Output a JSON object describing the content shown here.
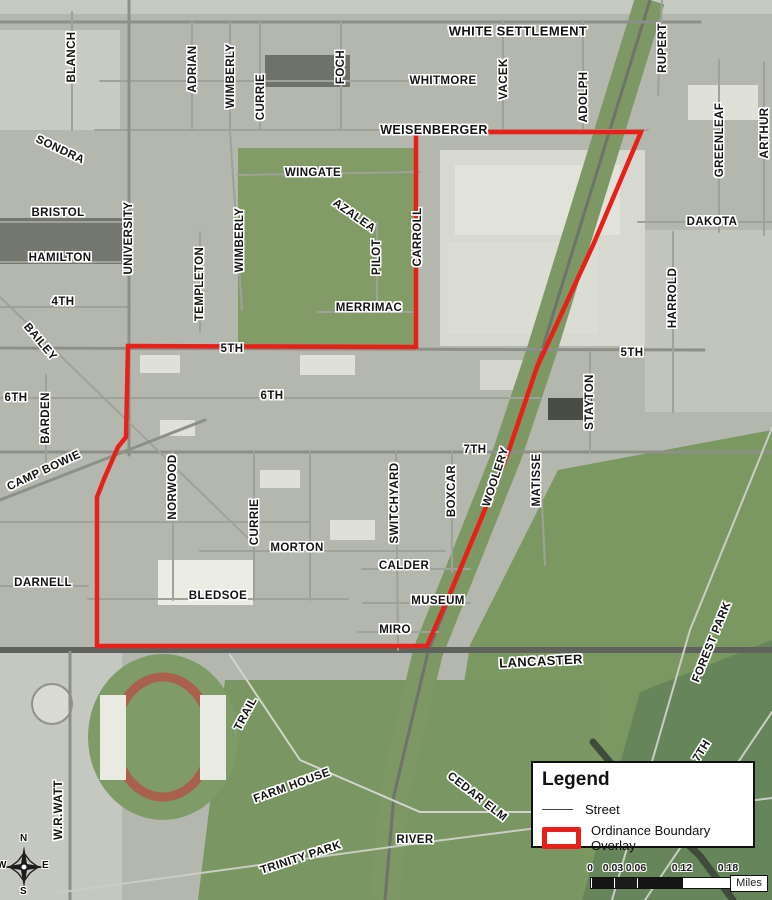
{
  "map": {
    "width": 772,
    "height": 900,
    "colors": {
      "boundary": "#e8201a",
      "road_main": "#8d9088",
      "road_minor": "#9fa29a",
      "road_light": "#c9cdc4",
      "road_dark": "#60635c",
      "rail_band": "#7d9765"
    },
    "boundary_points": "416,132 641,132 594,243 537,367 509,450 479,524 451,591 427,646 97,646 97,497 104,479 118,447 126,437 128,346 416,347",
    "patches": [
      {
        "r": [
          0,
          0,
          772,
          14
        ],
        "c": "#c6c9c2"
      },
      {
        "r": [
          0,
          30,
          120,
          100
        ],
        "c": "#c8cbc4"
      },
      {
        "r": [
          238,
          148,
          180,
          200
        ],
        "c": "#839b67"
      },
      {
        "r": [
          440,
          150,
          205,
          196
        ],
        "c": "#d7d8d0"
      },
      {
        "r": [
          645,
          230,
          127,
          182
        ],
        "c": "#c2c5bd"
      },
      {
        "p": "558,470 772,430 772,900 430,900 470,645",
        "c": "#7c9862"
      },
      {
        "p": "225,680 600,680 578,900 198,900",
        "c": "#7a9663"
      },
      {
        "p": "640,692 772,640 772,900 582,900",
        "c": "#67855a"
      },
      {
        "r": [
          0,
          652,
          122,
          248
        ],
        "c": "#c5c8c1"
      },
      {
        "r": [
          0,
          218,
          125,
          46
        ],
        "c": "#74776e"
      },
      {
        "r": [
          265,
          55,
          85,
          32
        ],
        "c": "#6f7268"
      },
      {
        "r": [
          455,
          165,
          165,
          70
        ],
        "c": "#e1e2da"
      },
      {
        "r": [
          448,
          242,
          150,
          92
        ],
        "c": "#dbdcd4"
      },
      {
        "r": [
          158,
          560,
          95,
          45
        ],
        "c": "#ebede5"
      },
      {
        "r": [
          688,
          85,
          70,
          35
        ],
        "c": "#dfe0d8"
      },
      {
        "r": [
          548,
          398,
          44,
          22
        ],
        "c": "#4a4d46"
      },
      {
        "r": [
          140,
          355,
          40,
          18
        ],
        "c": "#dfe0d8"
      },
      {
        "r": [
          300,
          355,
          55,
          20
        ],
        "c": "#dfe0d8"
      },
      {
        "r": [
          160,
          420,
          35,
          16
        ],
        "c": "#dfe0d8"
      },
      {
        "r": [
          260,
          470,
          40,
          18
        ],
        "c": "#dfe0d8"
      },
      {
        "r": [
          330,
          520,
          45,
          20
        ],
        "c": "#dfe0d8"
      },
      {
        "r": [
          480,
          360,
          60,
          30
        ],
        "c": "#d4d5cd"
      },
      {
        "e": [
          163,
          737,
          75,
          83
        ],
        "c": "#7f9b68"
      },
      {
        "e": [
          163,
          737,
          48,
          60
        ],
        "c": "none",
        "sc": "#a9614e",
        "sw": 9
      },
      {
        "r": [
          100,
          695,
          26,
          85
        ],
        "c": "#e9ebe3"
      },
      {
        "r": [
          200,
          695,
          26,
          85
        ],
        "c": "#e9ebe3"
      },
      {
        "e": [
          52,
          704,
          20,
          20
        ],
        "c": "#d9dad2",
        "sc": "#8f928a",
        "sw": 2
      }
    ],
    "bands": [
      [
        "650,0 542,350 508,452 428,652 394,795 385,900",
        30,
        "#7d9765"
      ]
    ],
    "streets": [
      [
        "650,0 542,350 508,452 428,652 394,795 385,900",
        3,
        "#6e746a"
      ],
      [
        "0,22 700,22",
        3,
        "#8d9088"
      ],
      [
        "100,81 462,81",
        2,
        "#9fa29a"
      ],
      [
        "95,130 648,130",
        2,
        "#9fa29a"
      ],
      [
        "238,175 420,172",
        2,
        "#9fa29a"
      ],
      [
        "638,222 772,222",
        2,
        "#9fa29a"
      ],
      [
        "0,222 130,222",
        2,
        "#9fa29a"
      ],
      [
        "0,262 130,262",
        2,
        "#9fa29a"
      ],
      [
        "0,307 130,307",
        2,
        "#9fa29a"
      ],
      [
        "318,312 417,312",
        2,
        "#9fa29a"
      ],
      [
        "0,348 704,350",
        3,
        "#8d9088"
      ],
      [
        "0,398 540,398",
        2,
        "#9fa29a"
      ],
      [
        "0,452 772,452",
        3,
        "#8d9088"
      ],
      [
        "0,522 310,522",
        2,
        "#9fa29a"
      ],
      [
        "200,551 445,551",
        2,
        "#9fa29a"
      ],
      [
        "362,569 470,569",
        2,
        "#9fa29a"
      ],
      [
        "88,599 348,599",
        2,
        "#9fa29a"
      ],
      [
        "0,586 88,586",
        2,
        "#9fa29a"
      ],
      [
        "363,603 470,603",
        2,
        "#9fa29a"
      ],
      [
        "358,632 438,632",
        2,
        "#9fa29a"
      ],
      [
        "0,650 772,650",
        6,
        "#60635c"
      ],
      [
        "72,12 72,130",
        2,
        "#9fa29a"
      ],
      [
        "129,0 129,455",
        3,
        "#8d9088"
      ],
      [
        "192,22 192,130",
        2,
        "#9fa29a"
      ],
      [
        "230,22 230,130",
        2,
        "#9fa29a"
      ],
      [
        "260,22 260,130",
        2,
        "#9fa29a"
      ],
      [
        "341,22 341,130",
        2,
        "#9fa29a"
      ],
      [
        "417,130 417,350",
        2,
        "#9fa29a"
      ],
      [
        "503,22 503,130",
        2,
        "#9fa29a"
      ],
      [
        "583,22 583,130",
        2,
        "#9fa29a"
      ],
      [
        "662,0 658,95",
        2,
        "#9fa29a"
      ],
      [
        "719,60 719,232",
        2,
        "#9fa29a"
      ],
      [
        "764,62 764,235",
        2,
        "#9fa29a"
      ],
      [
        "673,232 673,412",
        2,
        "#9fa29a"
      ],
      [
        "590,352 590,452",
        2,
        "#9fa29a"
      ],
      [
        "46,375 46,467",
        2,
        "#9fa29a"
      ],
      [
        "173,452 173,600",
        2,
        "#9fa29a"
      ],
      [
        "254,452 254,600",
        2,
        "#9fa29a"
      ],
      [
        "310,452 310,600",
        2,
        "#9fa29a"
      ],
      [
        "452,452 452,572",
        2,
        "#9fa29a"
      ],
      [
        "396,452 398,650",
        2,
        "#9fa29a"
      ],
      [
        "70,652 70,900",
        3,
        "#8d9088"
      ],
      [
        "230,132 242,310",
        2,
        "#9fa29a"
      ],
      [
        "377,222 377,302",
        2,
        "#9fa29a"
      ],
      [
        "200,232 200,332",
        2,
        "#9fa29a"
      ],
      [
        "540,462 545,565",
        2,
        "#9fa29a"
      ],
      [
        "0,297 255,545",
        2,
        "#9fa29a"
      ],
      [
        "0,500 205,420",
        3,
        "#8d9088"
      ],
      [
        "772,428 690,630 612,900",
        2,
        "#c9cdc4"
      ],
      [
        "593,742 642,800 700,856 733,900",
        7,
        "#3f4c3b"
      ],
      [
        "55,893 420,843 772,798",
        2,
        "#c9cdc4"
      ],
      [
        "645,900 772,712",
        2,
        "#c9cdc4"
      ],
      [
        "230,655 300,760 420,812 560,812",
        2,
        "#d2d5cd"
      ]
    ],
    "labels": [
      [
        "BLANCH",
        72,
        57,
        -90
      ],
      [
        "SONDRA",
        60,
        150,
        25
      ],
      [
        "ADRIAN",
        193,
        69,
        -90
      ],
      [
        "WIMBERLY",
        231,
        76,
        -90
      ],
      [
        "CURRIE",
        261,
        97,
        -90
      ],
      [
        "FOCH",
        341,
        67,
        -90
      ],
      [
        "WHITE SETTLEMENT",
        518,
        31,
        0,
        13
      ],
      [
        "WHITMORE",
        443,
        81,
        0
      ],
      [
        "VACEK",
        504,
        79,
        -90
      ],
      [
        "ADOLPH",
        584,
        97,
        -90
      ],
      [
        "RUPERT",
        663,
        48,
        -90
      ],
      [
        "GREENLEAF",
        720,
        140,
        -90
      ],
      [
        "ARTHUR",
        765,
        133,
        -90
      ],
      [
        "WEISENBERGER",
        434,
        130,
        0,
        12.5
      ],
      [
        "WINGATE",
        313,
        173,
        0
      ],
      [
        "AZALEA",
        354,
        216,
        35
      ],
      [
        "WIMBERLY",
        240,
        240,
        -90
      ],
      [
        "PILOT",
        377,
        257,
        -90
      ],
      [
        "CARROLL",
        418,
        237,
        -90
      ],
      [
        "MERRIMAC",
        369,
        308,
        0
      ],
      [
        "UNIVERSITY",
        129,
        238,
        -90
      ],
      [
        "TEMPLETON",
        200,
        284,
        -90
      ],
      [
        "BRISTOL",
        58,
        213,
        0
      ],
      [
        "HAMILTON",
        60,
        258,
        0
      ],
      [
        "4TH",
        63,
        302,
        0
      ],
      [
        "DAKOTA",
        712,
        222,
        0
      ],
      [
        "HARROLD",
        673,
        298,
        -90
      ],
      [
        "5TH",
        632,
        353,
        0
      ],
      [
        "5TH",
        232,
        349,
        0
      ],
      [
        "BAILEY",
        40,
        342,
        50
      ],
      [
        "6TH",
        16,
        398,
        0
      ],
      [
        "6TH",
        272,
        396,
        0
      ],
      [
        "BARDEN",
        46,
        418,
        -90
      ],
      [
        "CAMP BOWIE",
        44,
        471,
        -25
      ],
      [
        "7TH",
        475,
        450,
        0
      ],
      [
        "WOOLERY",
        496,
        477,
        -72
      ],
      [
        "STAYTON",
        590,
        402,
        -90
      ],
      [
        "MATISSE",
        537,
        480,
        -90
      ],
      [
        "NORWOOD",
        173,
        487,
        -90
      ],
      [
        "CURRIE",
        255,
        522,
        -90
      ],
      [
        "SWITCHYARD",
        395,
        503,
        -90
      ],
      [
        "BOXCAR",
        452,
        491,
        -90
      ],
      [
        "MORTON",
        297,
        548,
        0
      ],
      [
        "CALDER",
        404,
        566,
        0
      ],
      [
        "BLEDSOE",
        218,
        596,
        0
      ],
      [
        "DARNELL",
        43,
        583,
        0
      ],
      [
        "MUSEUM",
        438,
        601,
        0
      ],
      [
        "MIRO",
        395,
        630,
        0
      ],
      [
        "LANCASTER",
        541,
        661,
        -3,
        13
      ],
      [
        "FOREST PARK",
        712,
        642,
        -68
      ],
      [
        "W.R.WATT",
        59,
        810,
        -90
      ],
      [
        "TRAIL",
        246,
        714,
        -62
      ],
      [
        "FARM HOUSE",
        292,
        786,
        -20
      ],
      [
        "CEDAR ELM",
        477,
        797,
        38
      ],
      [
        "RIVER",
        415,
        840,
        0
      ],
      [
        "TRINITY PARK",
        301,
        858,
        -18
      ],
      [
        "7TH",
        702,
        751,
        -58
      ]
    ]
  },
  "legend": {
    "title": "Legend",
    "items": [
      {
        "label": "Street",
        "symbol": "line"
      },
      {
        "label": "Ordinance Boundary Overlay",
        "symbol": "red-rect"
      }
    ]
  },
  "scalebar": {
    "ticks": [
      [
        "0",
        0
      ],
      [
        "0.03",
        23
      ],
      [
        "0.06",
        46
      ],
      [
        "0.12",
        92
      ],
      [
        "0.18",
        138
      ]
    ],
    "segments": [
      [
        0,
        23,
        "#151515"
      ],
      [
        23,
        46,
        "#1c1c1c"
      ],
      [
        46,
        92,
        "#151515"
      ],
      [
        92,
        138,
        "#ffffff"
      ]
    ],
    "unit": "Miles"
  },
  "compass": {
    "n": "N",
    "e": "E",
    "s": "S",
    "w": "W"
  }
}
